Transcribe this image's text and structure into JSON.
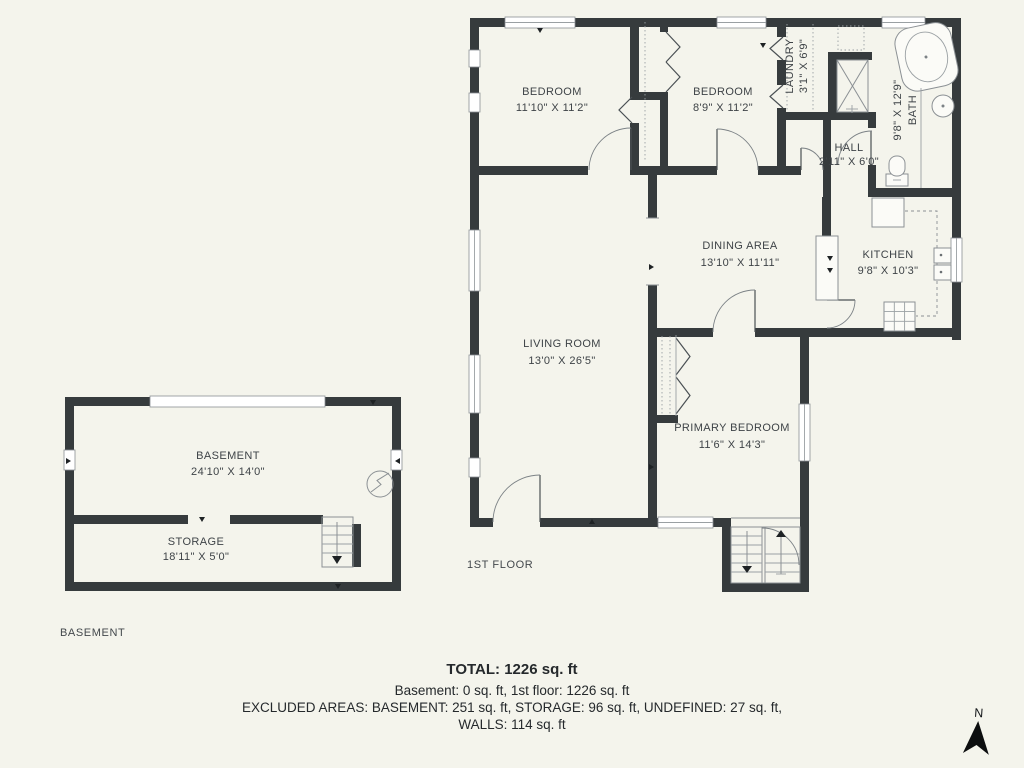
{
  "page": {
    "background": "#f4f4ec",
    "wall_color": "#363b3d",
    "accent_text_color": "#3e4347"
  },
  "first_floor": {
    "label": "1ST FLOOR",
    "rooms": [
      {
        "name": "BEDROOM",
        "dims": "11'10\" X 11'2\""
      },
      {
        "name": "BEDROOM",
        "dims": "8'9\" X 11'2\""
      },
      {
        "name": "LAUNDRY",
        "dims": "3'1\" X 6'9\""
      },
      {
        "name": "BATH",
        "dims": "9'8\" X 12'9\""
      },
      {
        "name": "HALL",
        "dims": "2'11\" X 6'0\""
      },
      {
        "name": "DINING AREA",
        "dims": "13'10\" X 11'11\""
      },
      {
        "name": "KITCHEN",
        "dims": "9'8\" X 10'3\""
      },
      {
        "name": "LIVING ROOM",
        "dims": "13'0\" X 26'5\""
      },
      {
        "name": "PRIMARY BEDROOM",
        "dims": "11'6\" X 14'3\""
      }
    ]
  },
  "basement_floor": {
    "label": "BASEMENT",
    "rooms": [
      {
        "name": "BASEMENT",
        "dims": "24'10\" X 14'0\""
      },
      {
        "name": "STORAGE",
        "dims": "18'11\" X 5'0\""
      }
    ]
  },
  "summary": {
    "total": "TOTAL: 1226 sq. ft",
    "floors": "Basement: 0 sq. ft, 1st floor: 1226 sq. ft",
    "excluded": "EXCLUDED AREAS: BASEMENT: 251 sq. ft, STORAGE: 96 sq. ft, UNDEFINED: 27 sq. ft,",
    "walls": "WALLS: 114 sq. ft"
  },
  "compass": {
    "north_label": "N"
  },
  "icons": {
    "bathtub": "oval-tub-shape",
    "toilet": "rounded-rect",
    "sink": "circle",
    "shower": "x-box",
    "stove": "grid-box",
    "electrical-panel": "circle-lightning",
    "stairs": "tread-lines-arrow",
    "north-arrow": "filled-arrowhead"
  }
}
